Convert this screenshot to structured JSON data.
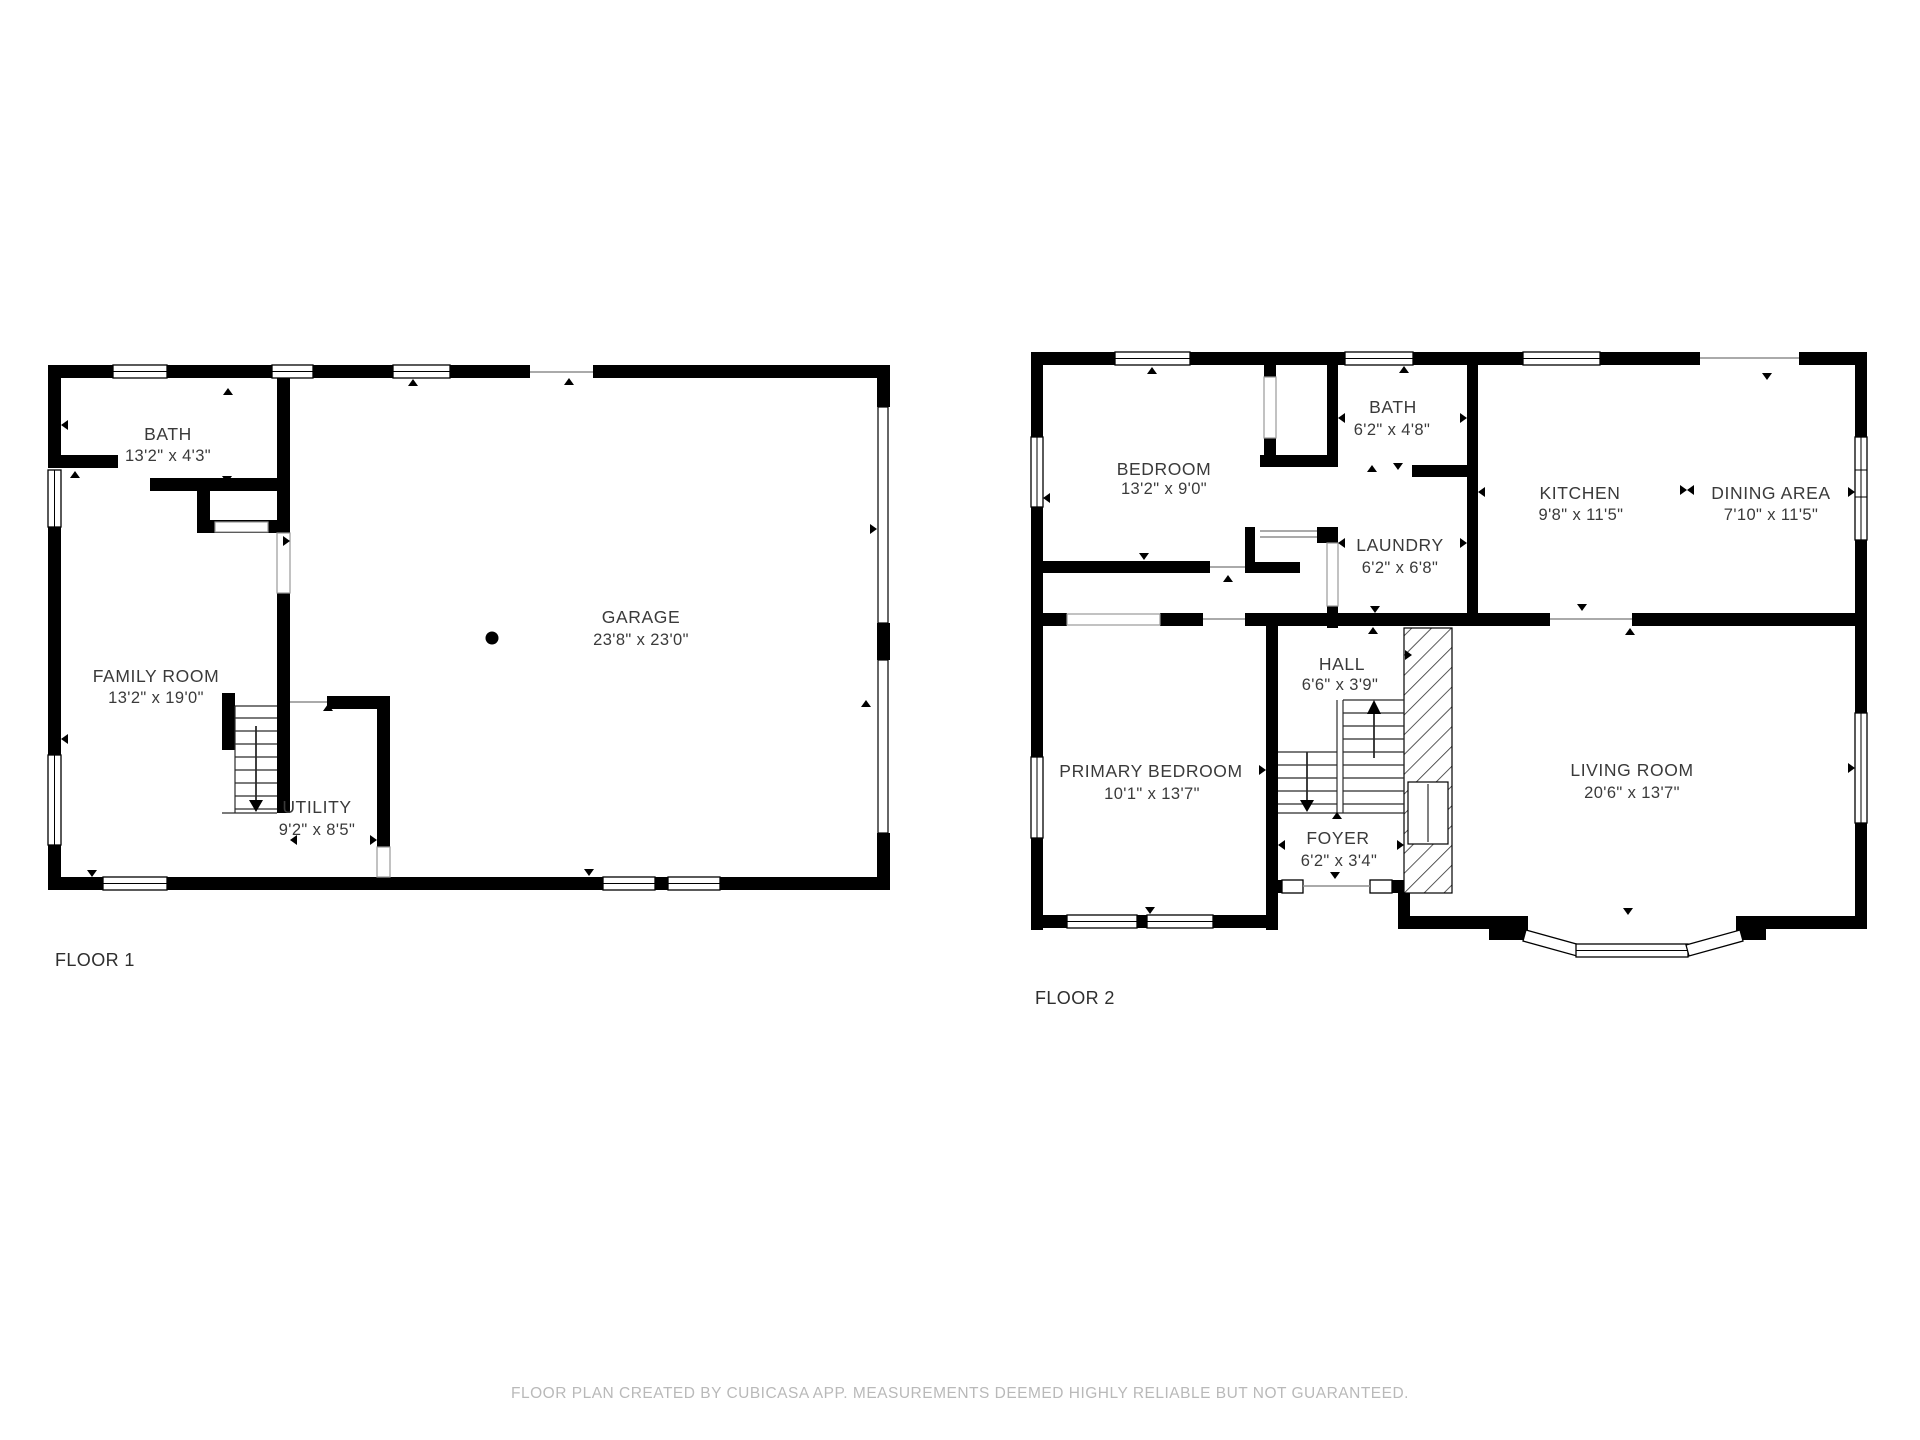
{
  "floors": [
    {
      "label": "FLOOR 1",
      "rooms": [
        {
          "name": "BATH",
          "dims": "13'2\" x 4'3\""
        },
        {
          "name": "FAMILY ROOM",
          "dims": "13'2\" x 19'0\""
        },
        {
          "name": "GARAGE",
          "dims": "23'8\" x 23'0\""
        },
        {
          "name": "UTILITY",
          "dims": "9'2\" x 8'5\""
        }
      ]
    },
    {
      "label": "FLOOR 2",
      "rooms": [
        {
          "name": "BEDROOM",
          "dims": "13'2\" x 9'0\""
        },
        {
          "name": "BATH",
          "dims": "6'2\" x 4'8\""
        },
        {
          "name": "LAUNDRY",
          "dims": "6'2\" x 6'8\""
        },
        {
          "name": "KITCHEN",
          "dims": "9'8\" x 11'5\""
        },
        {
          "name": "DINING AREA",
          "dims": "7'10\" x 11'5\""
        },
        {
          "name": "HALL",
          "dims": "6'6\" x 3'9\""
        },
        {
          "name": "PRIMARY BEDROOM",
          "dims": "10'1\" x 13'7\""
        },
        {
          "name": "FOYER",
          "dims": "6'2\" x 3'4\""
        },
        {
          "name": "LIVING ROOM",
          "dims": "20'6\" x 13'7\""
        }
      ]
    }
  ],
  "footer": {
    "text": "FLOOR PLAN CREATED BY CUBICASA APP. MEASUREMENTS DEEMED HIGHLY RELIABLE BUT NOT GUARANTEED."
  },
  "colors": {
    "wall": "#000000",
    "background": "#ffffff",
    "room_text": "#3a3a3a",
    "floor_label_text": "#2e2e2e",
    "footer_text": "#b9b9b9"
  }
}
